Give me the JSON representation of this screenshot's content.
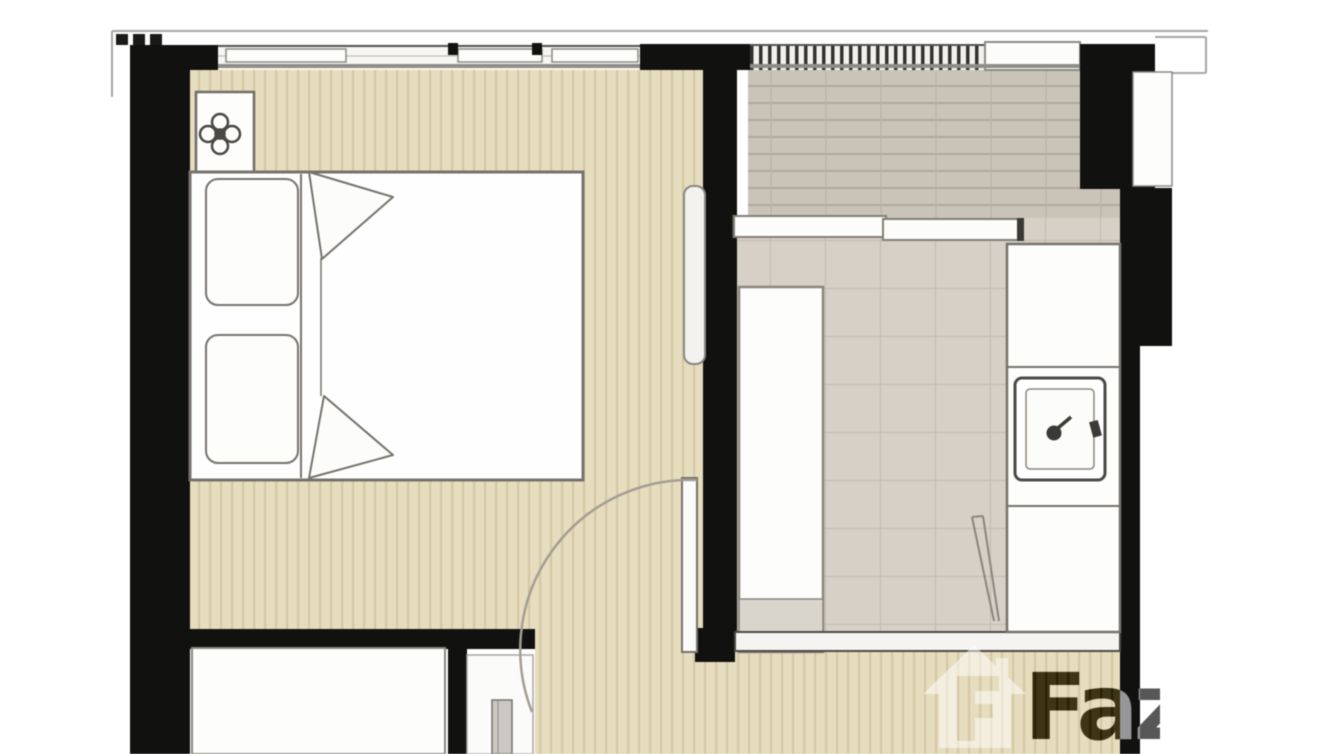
{
  "meta": {
    "kind": "real-estate floor plan",
    "description": "Top-down unit floor plan of a one-bedroom condo: bedroom with double bed on the left, living/kitchen area on the right, tiled balcony with sliding door at top right, built-in wardrobe and bathroom nook at bottom left, entrance hallway along the bottom."
  },
  "watermark": {
    "text": "Faz",
    "logo": "fazwaz-house-logo"
  },
  "plan": {
    "rooms": [
      {
        "id": "bedroom",
        "label": "Bedroom",
        "floor": "wood-plank"
      },
      {
        "id": "living-kitchen",
        "label": "Living / Kitchen",
        "floor": "large-tile"
      },
      {
        "id": "balcony",
        "label": "Balcony / wet area",
        "floor": "striped-tile"
      },
      {
        "id": "hallway",
        "label": "Hallway",
        "floor": "wood-plank"
      },
      {
        "id": "bathroom-nook",
        "label": "Bathroom nook (partial)",
        "floor": "white"
      },
      {
        "id": "wardrobe",
        "label": "Built-in wardrobe",
        "floor": "white"
      }
    ],
    "furniture": [
      {
        "id": "double-bed",
        "room": "bedroom",
        "details": "white bed, two pillows, folded blanket corners"
      },
      {
        "id": "bedside-table",
        "room": "bedroom",
        "details": "white table with ceiling-light rosette symbol"
      },
      {
        "id": "ac-wall-panel",
        "room": "bedroom"
      },
      {
        "id": "swing-door",
        "room": "bedroom",
        "details": "door leaf on divider wall with quarter-circle swing arc"
      },
      {
        "id": "sliding-door",
        "room": "balcony",
        "details": "two offset sliding panels"
      },
      {
        "id": "sofa",
        "room": "living-kitchen",
        "details": "long white sofa against divider wall, gray foot section"
      },
      {
        "id": "kitchen-counter",
        "room": "living-kitchen",
        "details": "three-section counter along right wall"
      },
      {
        "id": "kitchen-sink",
        "room": "living-kitchen",
        "details": "square sink with faucet"
      },
      {
        "id": "refrigerator-wedge",
        "room": "living-kitchen",
        "details": "thin V wedge lines beside counter"
      },
      {
        "id": "bathroom-fixture",
        "room": "bathroom-nook"
      }
    ],
    "windows": [
      {
        "id": "bedroom-window-band",
        "position": "top wall left"
      },
      {
        "id": "living-window-band",
        "position": "top wall right, dense mullions"
      },
      {
        "id": "window-sill",
        "position": "top right"
      }
    ]
  },
  "colors": {
    "background": "#ffffff",
    "wall": "#111210",
    "bedroom_floor": "#e6ddbe",
    "bedroom_floor_stripe": "#d4c7a5",
    "living_floor": "#d6d0c6",
    "living_floor_line": "#bdb5a8",
    "balcony_floor": "#cac3b8",
    "balcony_floor_line": "#b0a99d",
    "furniture_outline": "#76726c",
    "exterior_line": "#a6a6a2",
    "watermark_gray": "#a8a8a8"
  }
}
